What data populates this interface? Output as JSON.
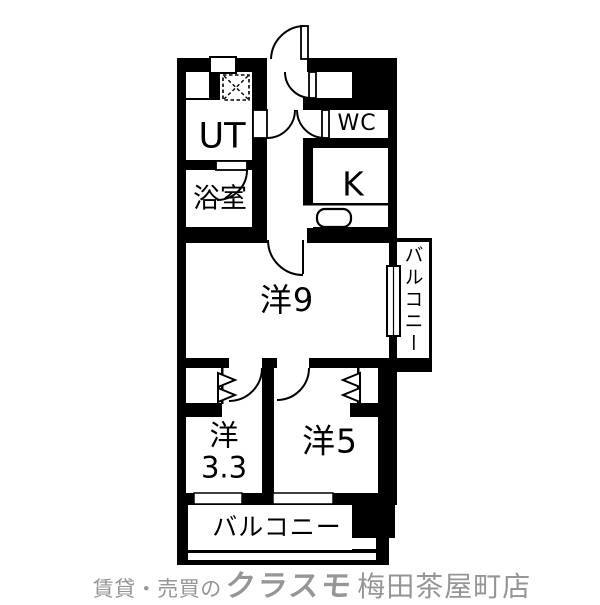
{
  "colors": {
    "wall": "#000000",
    "floor": "#ffffff",
    "footer_text": "#969696"
  },
  "floorplan": {
    "labels": {
      "ut": "UT",
      "bathroom": "浴室",
      "wc": "WC",
      "kitchen": "K",
      "western9": "洋9",
      "western33_line1": "洋",
      "western33_line2": "3.3",
      "western5": "洋5",
      "balcony_side": "バルコニー",
      "balcony_bottom": "バルコニー"
    }
  },
  "footer": {
    "prefix": "賃貸・売買の",
    "brand": "クラスモ",
    "branch": "梅田茶屋町店"
  }
}
